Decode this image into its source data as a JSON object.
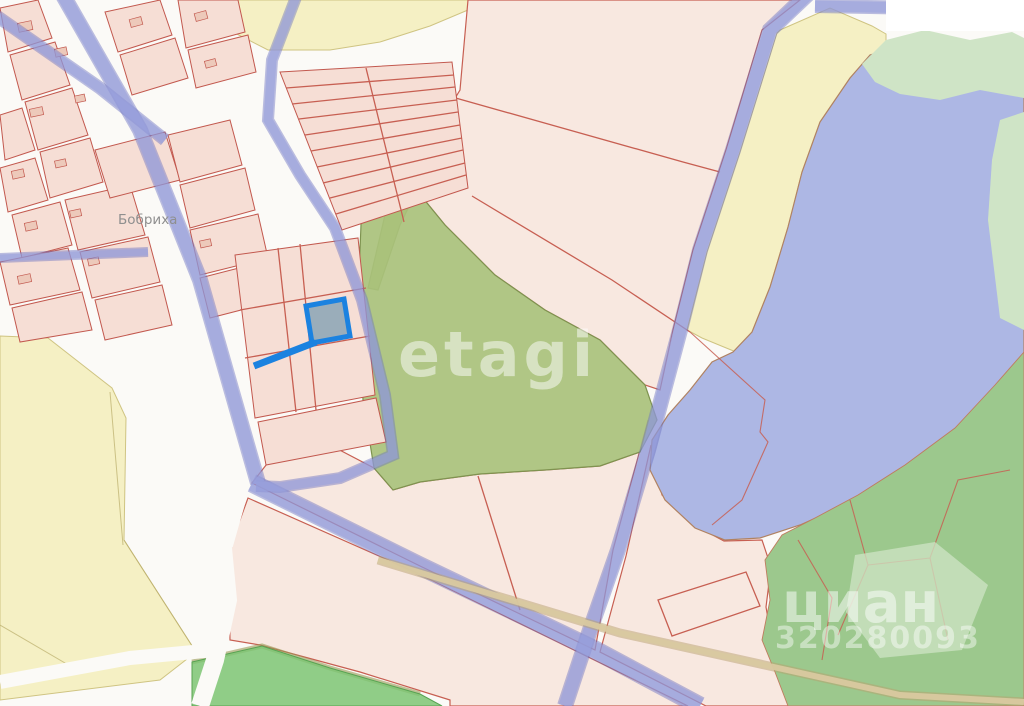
{
  "map": {
    "place_label": "Бобриха",
    "watermarks": {
      "etagi": "etagi",
      "cian": "циан",
      "cian_id": "320280093"
    },
    "selected_parcel": {
      "status": "selected",
      "outline_color": "#1b82e0",
      "fill_color": "#8aa4b5"
    },
    "colors": {
      "village_parcel_fill": "#f6ded5",
      "field_parcel_fill": "#f8e8e0",
      "parcel_border": "#c2584e",
      "road_blue": "#99a1de",
      "road_edge_blue": "#6b72c0",
      "field_yellow": "#f5f0c4",
      "lake_blue": "#adb7e4",
      "shore_line_brown": "#b08262",
      "meadow_green": "#a9c17b",
      "forest_green": "#9cc88d",
      "bright_green": "#7cc473",
      "mint_green": "#cfe4c6",
      "dirt_road_tan": "#d9c9a0",
      "background": "#fbfaf7"
    }
  }
}
